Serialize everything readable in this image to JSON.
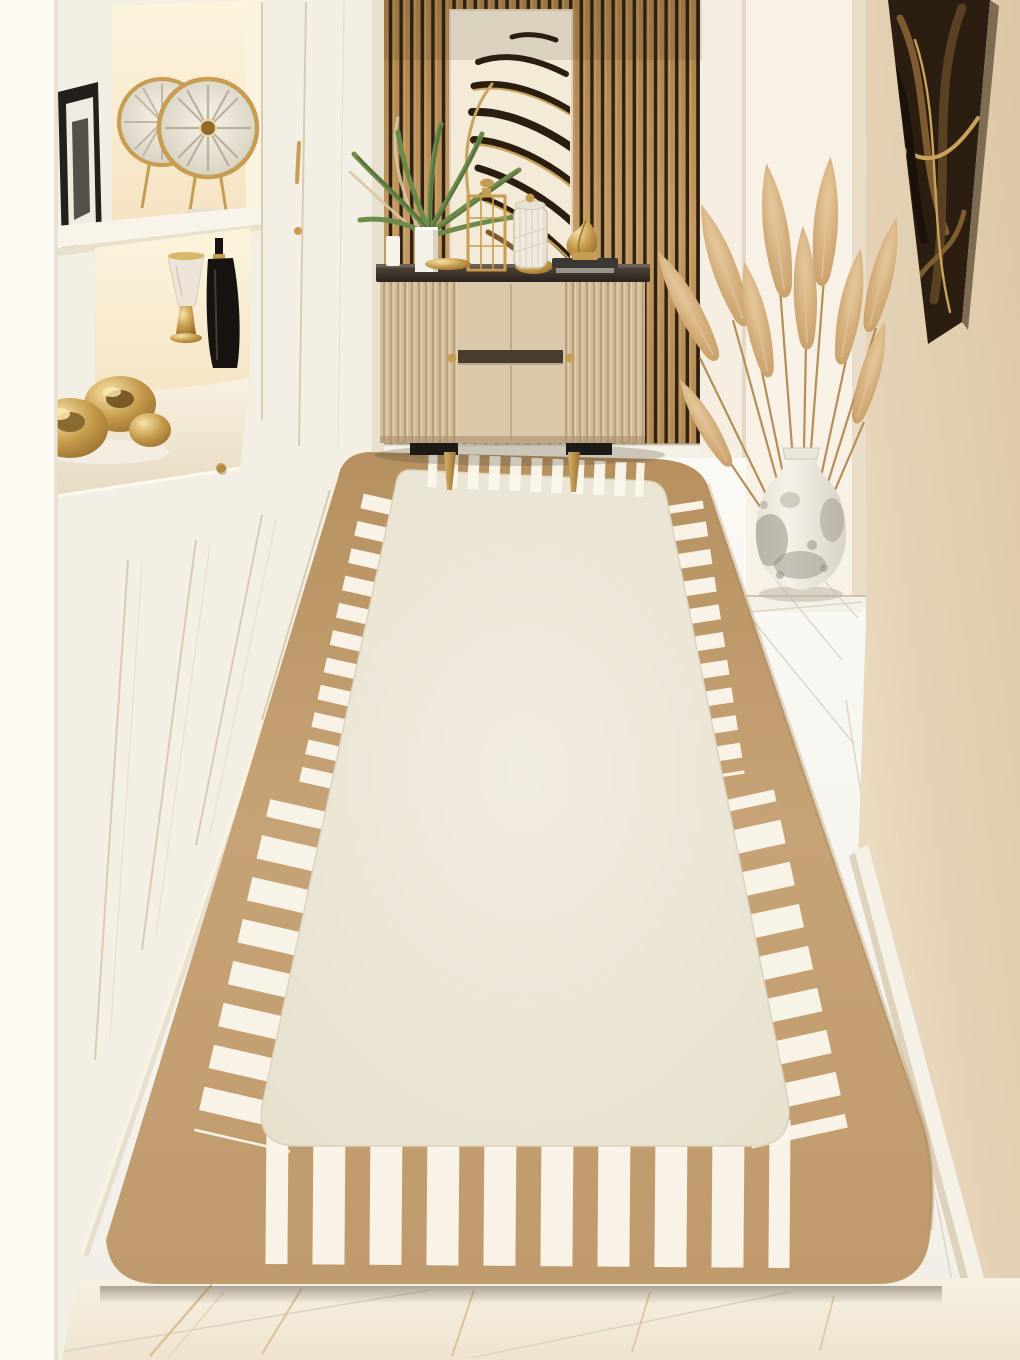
{
  "scene": {
    "label": "Hallway interior product photo of a beige runner rug with ivory field and white stitch border"
  },
  "palette": {
    "wall": "#f3ecdf",
    "wall_bright": "#faf6ec",
    "mid_wall": "#f5eee1",
    "niche_wall": "#f8f1e5",
    "right_wall": "#e2cfb3",
    "right_wall_light": "#eee0c9",
    "baseboard": "#f6f1e7",
    "cabinet_face": "#f4efe5",
    "cabinet_strip": "#fcfaf3",
    "cabinet_shadow": "#e5dcc9",
    "seam": "#d6c5a7",
    "niche_glow": "#fcf0d6",
    "counter": "#f2e9d7",
    "counter_edge": "#fdf9ef",
    "gold": "#c79d52",
    "gold_deep": "#8f6a2c",
    "gold_light": "#eed9a0",
    "dark_frame": "#23201c",
    "frame_mat": "#f0ebe1",
    "black_decor": "#161310",
    "marble_cup": "#ece4d6",
    "wood": "#c2945a",
    "wood_light": "#d5ab70",
    "slat_gap": "#2e2113",
    "art_canvas": "#f3ead8",
    "art_dark": "#2b1d10",
    "art_bronze": "#7e5c31",
    "art_gold": "#c9a25c",
    "glass_top": "#37302a",
    "glass_hi": "#6b6156",
    "sb_body": "#dbc7a9",
    "sb_flute": "#d2bb97",
    "sb_flute_dark": "#b7a07c",
    "sb_slot": "#4a3c2c",
    "leg_mount": "#1d1b18",
    "leg_gold": "#b68c48",
    "plant": "#6d8a4a",
    "plant_dark": "#52703b",
    "dried": "#d8c7a4",
    "jar_glass": "#efeadd",
    "jar_line": "#cdc3ae",
    "book": "#3a3835",
    "book_page": "#9a948a",
    "rug_border": "#c29e71",
    "rug_border_dark": "#a9875b",
    "rug_field": "#ebe6d6",
    "rug_dash": "#faf6ea",
    "rug_field_edge": "#dcd3bd",
    "floor_tile": "#f8f6f0",
    "floor_grout": "#d9d3c6",
    "marble": "#f3ebdb",
    "marble_vein": "#d9ba8e",
    "rug_shadow": "#6e6557",
    "vase_body": "#f1eee6",
    "vase_speckle": "#8e887c",
    "pampas": "#cfa473",
    "pampas_light": "#e3c296",
    "stem": "#b18a52"
  },
  "objects": {
    "shelving": {
      "label": "White hallway cabinetry with lit display shelves"
    },
    "discs": {
      "label": "Pair of gold decorative wall discs"
    },
    "frame": {
      "label": "Framed picture leaning on shelf"
    },
    "goblet": {
      "label": "Marble and gold goblet ornament"
    },
    "bottle": {
      "label": "Black bottle sculpture"
    },
    "gold_sculpture": {
      "label": "Gold abstract sculpture on countertop"
    },
    "doors": {
      "label": "Cream cabinet doors with brass knobs"
    },
    "slat_wall": {
      "label": "Wood slat accent wall"
    },
    "wall_art": {
      "label": "Abstract gold brushstroke artwork"
    },
    "console": {
      "label": "Beige fluted console cabinet with glass top"
    },
    "plant": {
      "label": "Potted palm plant"
    },
    "lantern": {
      "label": "Gold wire lantern"
    },
    "jar": {
      "label": "Ribbed glass jar with gold lid"
    },
    "ornament": {
      "label": "Gold twisted ornament on books"
    },
    "pampas": {
      "label": "Dried pampas grass arrangement"
    },
    "vase": {
      "label": "Speckled ceramic urn vase"
    },
    "right_art": {
      "label": "Dark abstract framed art on right wall"
    },
    "rug": {
      "label": "Beige runner rug with ivory field and white stitch border"
    },
    "floor": {
      "label": "Glossy white tile floor"
    },
    "marble_floor": {
      "label": "Cream marble floor in foreground"
    }
  }
}
